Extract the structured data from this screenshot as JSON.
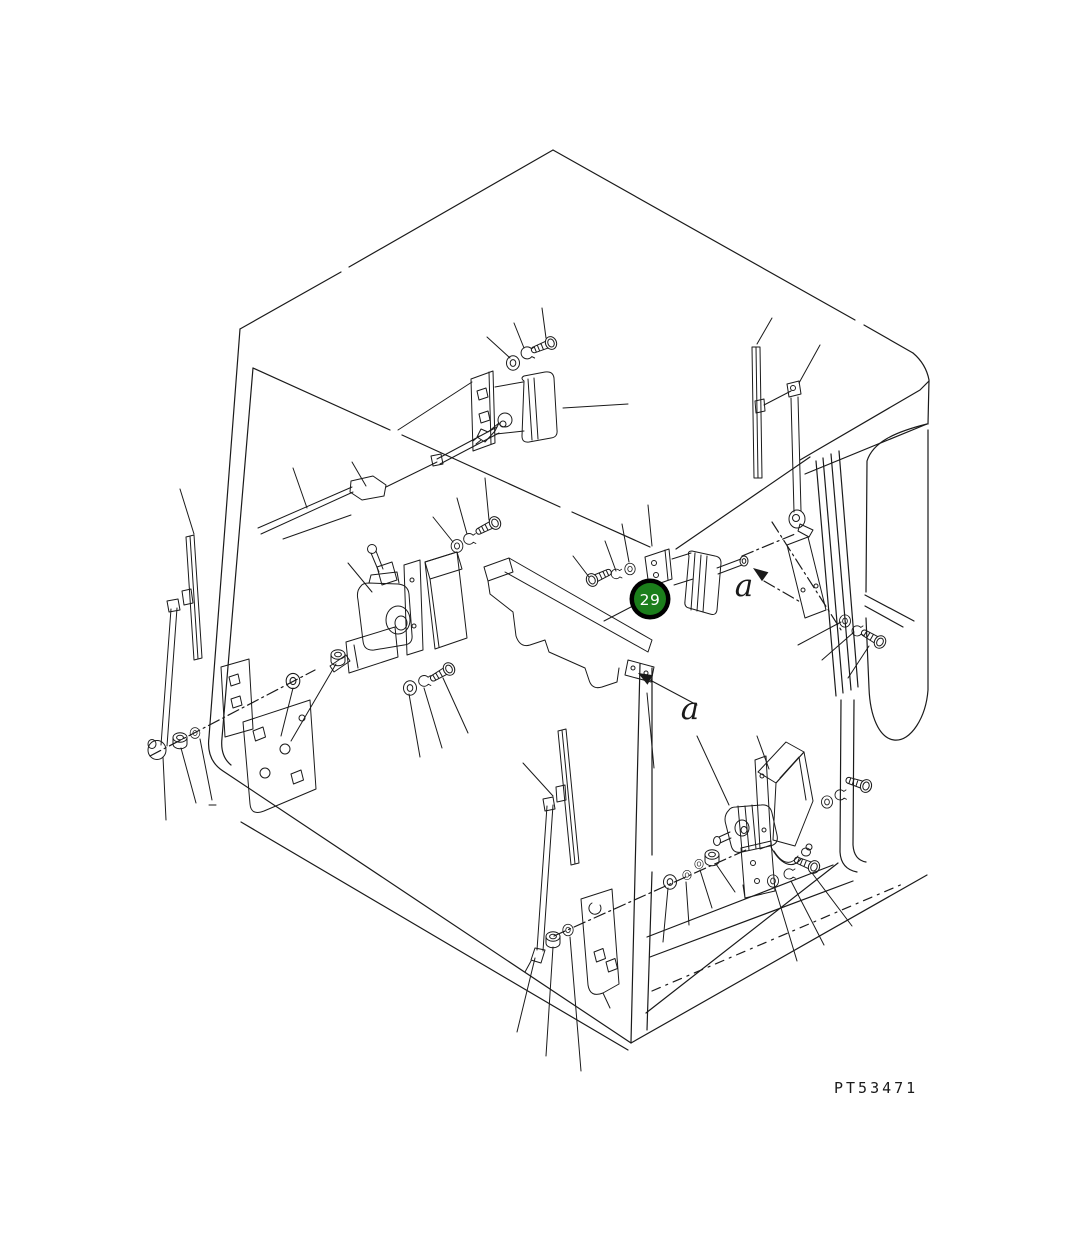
{
  "figure": {
    "kind": "exploded-parts-line-drawing",
    "subject": "operator cab wiper and wiper-motor assembly",
    "background_color": "#ffffff",
    "line_color": "#1a1a1a"
  },
  "labels": {
    "callout_29": "29",
    "ref_a_upper": "a",
    "ref_a_lower": "a",
    "drawing_code": "PT53471"
  },
  "callout": {
    "number": "29",
    "fill_color": "#1b7e1b",
    "ring_color": "#000000",
    "text_color": "#ffffff"
  },
  "components": [
    "cab wireframe",
    "top wiper motor with bracket",
    "stowed front wiper arm and linkage",
    "left wiper blade",
    "left wiper arm",
    "center wiper motor with lever and cover",
    "arm storage tray with end tab",
    "center-right wiper motor",
    "right wiper blade",
    "right wiper arm",
    "right mounting plate",
    "lower-right wiper motor with cover, bracket and cable",
    "lower wiper blade",
    "lower wiper arm",
    "door hinge plates",
    "assorted bolts, washers, snap rings and nuts"
  ]
}
